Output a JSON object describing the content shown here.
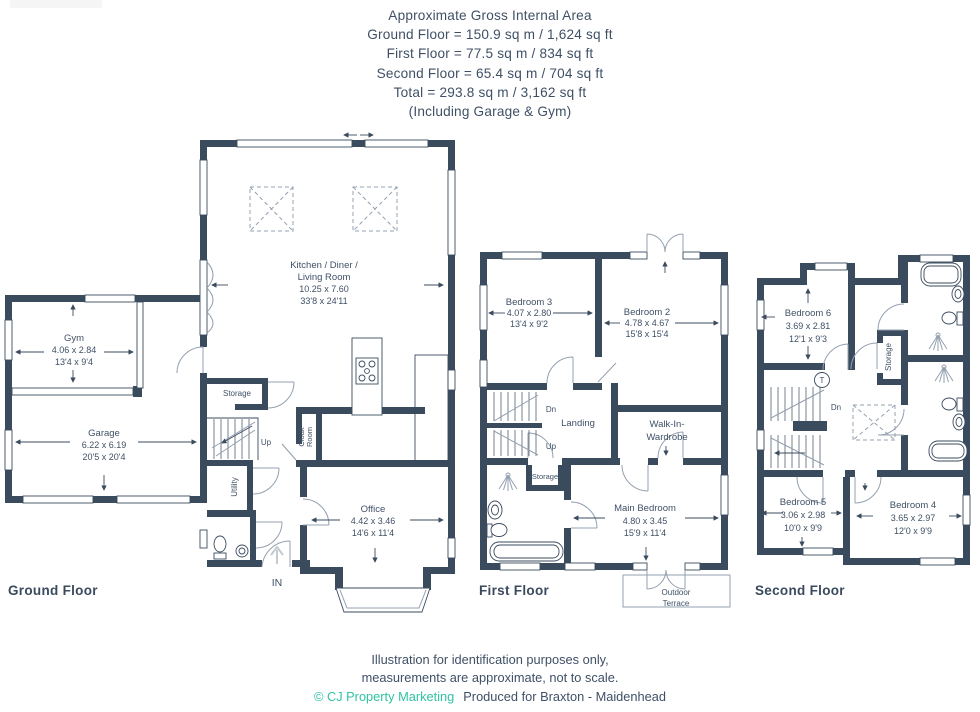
{
  "header": {
    "lines": [
      "Approximate Gross Internal Area",
      "Ground Floor = 150.9 sq m / 1,624 sq ft",
      "First Floor = 77.5 sq m / 834 sq ft",
      "Second Floor = 65.4 sq m / 704 sq ft",
      "Total = 293.8 sq m / 3,162 sq ft",
      "(Including Garage & Gym)"
    ]
  },
  "floors": {
    "ground": {
      "label": "Ground Floor",
      "rooms": {
        "kitchen": {
          "name_line1": "Kitchen / Diner /",
          "name_line2": "Living Room",
          "metric": "10.25 x 7.60",
          "imperial": "33'8 x 24'11"
        },
        "gym": {
          "name": "Gym",
          "metric": "4.06 x 2.84",
          "imperial": "13'4 x 9'4"
        },
        "garage": {
          "name": "Garage",
          "metric": "6.22 x 6.19",
          "imperial": "20'5 x 20'4"
        },
        "office": {
          "name": "Office",
          "metric": "4.42 x 3.46",
          "imperial": "14'6 x 11'4"
        },
        "storage": {
          "name": "Storage"
        },
        "utility": {
          "name": "Utility"
        },
        "cloak_room": {
          "name_line1": "Cloak",
          "name_line2": "Room"
        },
        "stairs": {
          "up": "Up"
        },
        "entrance": {
          "label": "IN"
        }
      }
    },
    "first": {
      "label": "First Floor",
      "rooms": {
        "bedroom3": {
          "name": "Bedroom 3",
          "metric": "4.07 x 2.80",
          "imperial": "13'4 x 9'2"
        },
        "bedroom2": {
          "name": "Bedroom 2",
          "metric": "4.78 x 4.67",
          "imperial": "15'8 x 15'4"
        },
        "main_bedroom": {
          "name": "Main Bedroom",
          "metric": "4.80 x 3.45",
          "imperial": "15'9 x 11'4"
        },
        "landing": {
          "name": "Landing"
        },
        "walk_in_wardrobe": {
          "name_line1": "Walk-In-",
          "name_line2": "Wardrobe"
        },
        "storage": {
          "name": "Storage"
        },
        "stairs": {
          "down": "Dn",
          "up": "Up"
        },
        "outdoor_terrace": {
          "name_line1": "Outdoor",
          "name_line2": "Terrace"
        }
      }
    },
    "second": {
      "label": "Second Floor",
      "rooms": {
        "bedroom6": {
          "name": "Bedroom 6",
          "metric": "3.69 x 2.81",
          "imperial": "12'1 x 9'3"
        },
        "bedroom5": {
          "name": "Bedroom 5",
          "metric": "3.06 x 2.98",
          "imperial": "10'0 x 9'9"
        },
        "bedroom4": {
          "name": "Bedroom 4",
          "metric": "3.65 x 2.97",
          "imperial": "12'0 x 9'9"
        },
        "storage": {
          "name": "Storage"
        },
        "stairs": {
          "down": "Dn"
        },
        "tank": {
          "label": "T"
        }
      }
    }
  },
  "footer": {
    "line1": "Illustration for identification purposes only,",
    "line2": "measurements are approximate, not to scale.",
    "credit": "© CJ Property Marketing",
    "produced": "Produced for Braxton - Maidenhead"
  },
  "colors": {
    "wall": "#3b4b5e",
    "accent": "#2fc3a4",
    "text": "#3f5066"
  }
}
